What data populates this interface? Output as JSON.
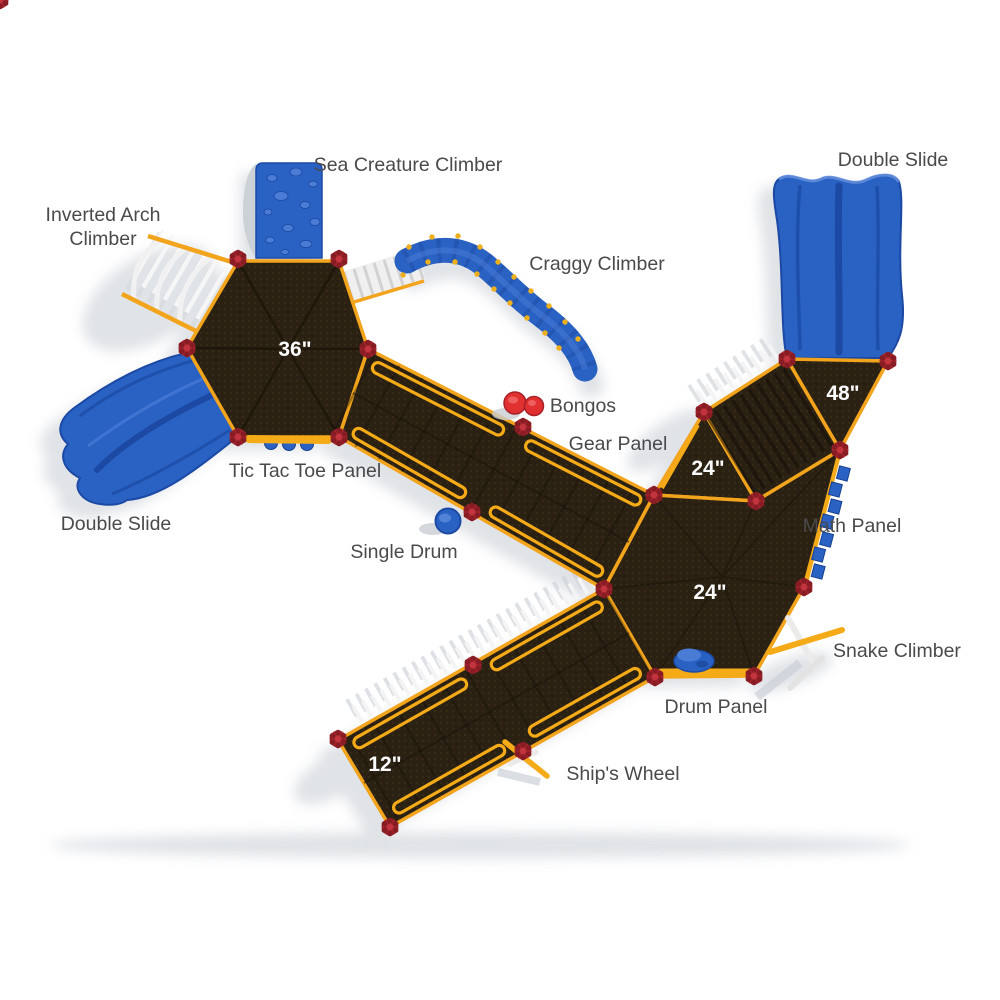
{
  "colors": {
    "background": "#ffffff",
    "deck_brown": "#2b2113",
    "deck_dot": "#3a2d1b",
    "rail_yellow": "#f2a41c",
    "connector_red": "#a3242c",
    "plastic_blue": "#2a62c4",
    "plastic_blue_dark": "#1b49a3",
    "label_gray": "#4a4a4c",
    "shadow_gray": "#c7ccd3"
  },
  "labels": {
    "sea_creature_climber": "Sea Creature Climber",
    "double_slide_top": "Double Slide",
    "inverted_arch_line1": "Inverted Arch",
    "inverted_arch_line2": "Climber",
    "craggy_climber": "Craggy Climber",
    "bongos": "Bongos",
    "gear_panel": "Gear Panel",
    "tic_tac_toe_panel": "Tic Tac Toe Panel",
    "double_slide_left": "Double Slide",
    "single_drum": "Single Drum",
    "math_panel": "Math Panel",
    "snake_climber": "Snake Climber",
    "drum_panel": "Drum Panel",
    "ships_wheel": "Ship's Wheel"
  },
  "deck_heights": {
    "main_hex": "36\"",
    "upper_right": "48\"",
    "mid_right": "24\"",
    "lower_right": "24\"",
    "bottom_left": "12\""
  }
}
